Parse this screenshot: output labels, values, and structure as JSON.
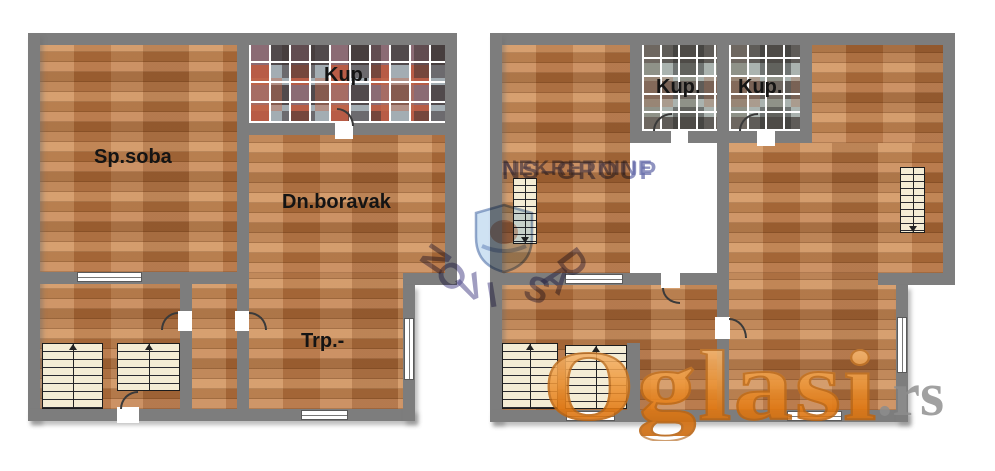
{
  "plans": {
    "left": {
      "rooms": {
        "bedroom": "Sp.soba",
        "bath": "Kup.",
        "living": "Dn.boravak",
        "dining": "Trp.-"
      }
    },
    "right": {
      "rooms": {
        "bath1": "Kup.",
        "bath2": "Kup."
      }
    }
  },
  "watermark": {
    "agency_line1": "NS–GROUP",
    "agency_line2": "NEKRETNINE",
    "arc_text": "NOVI SAD",
    "portal": "Oglasi",
    "portal_tld": ".rs"
  },
  "colors": {
    "wall": "#7d7d7d",
    "wood_base": "#bd7f4c",
    "stair_fill": "#f4ecd4",
    "watermark_blue": "#524c8c",
    "portal_orange": "#e8861f",
    "portal_tld_gray": "#8d8d8d"
  }
}
